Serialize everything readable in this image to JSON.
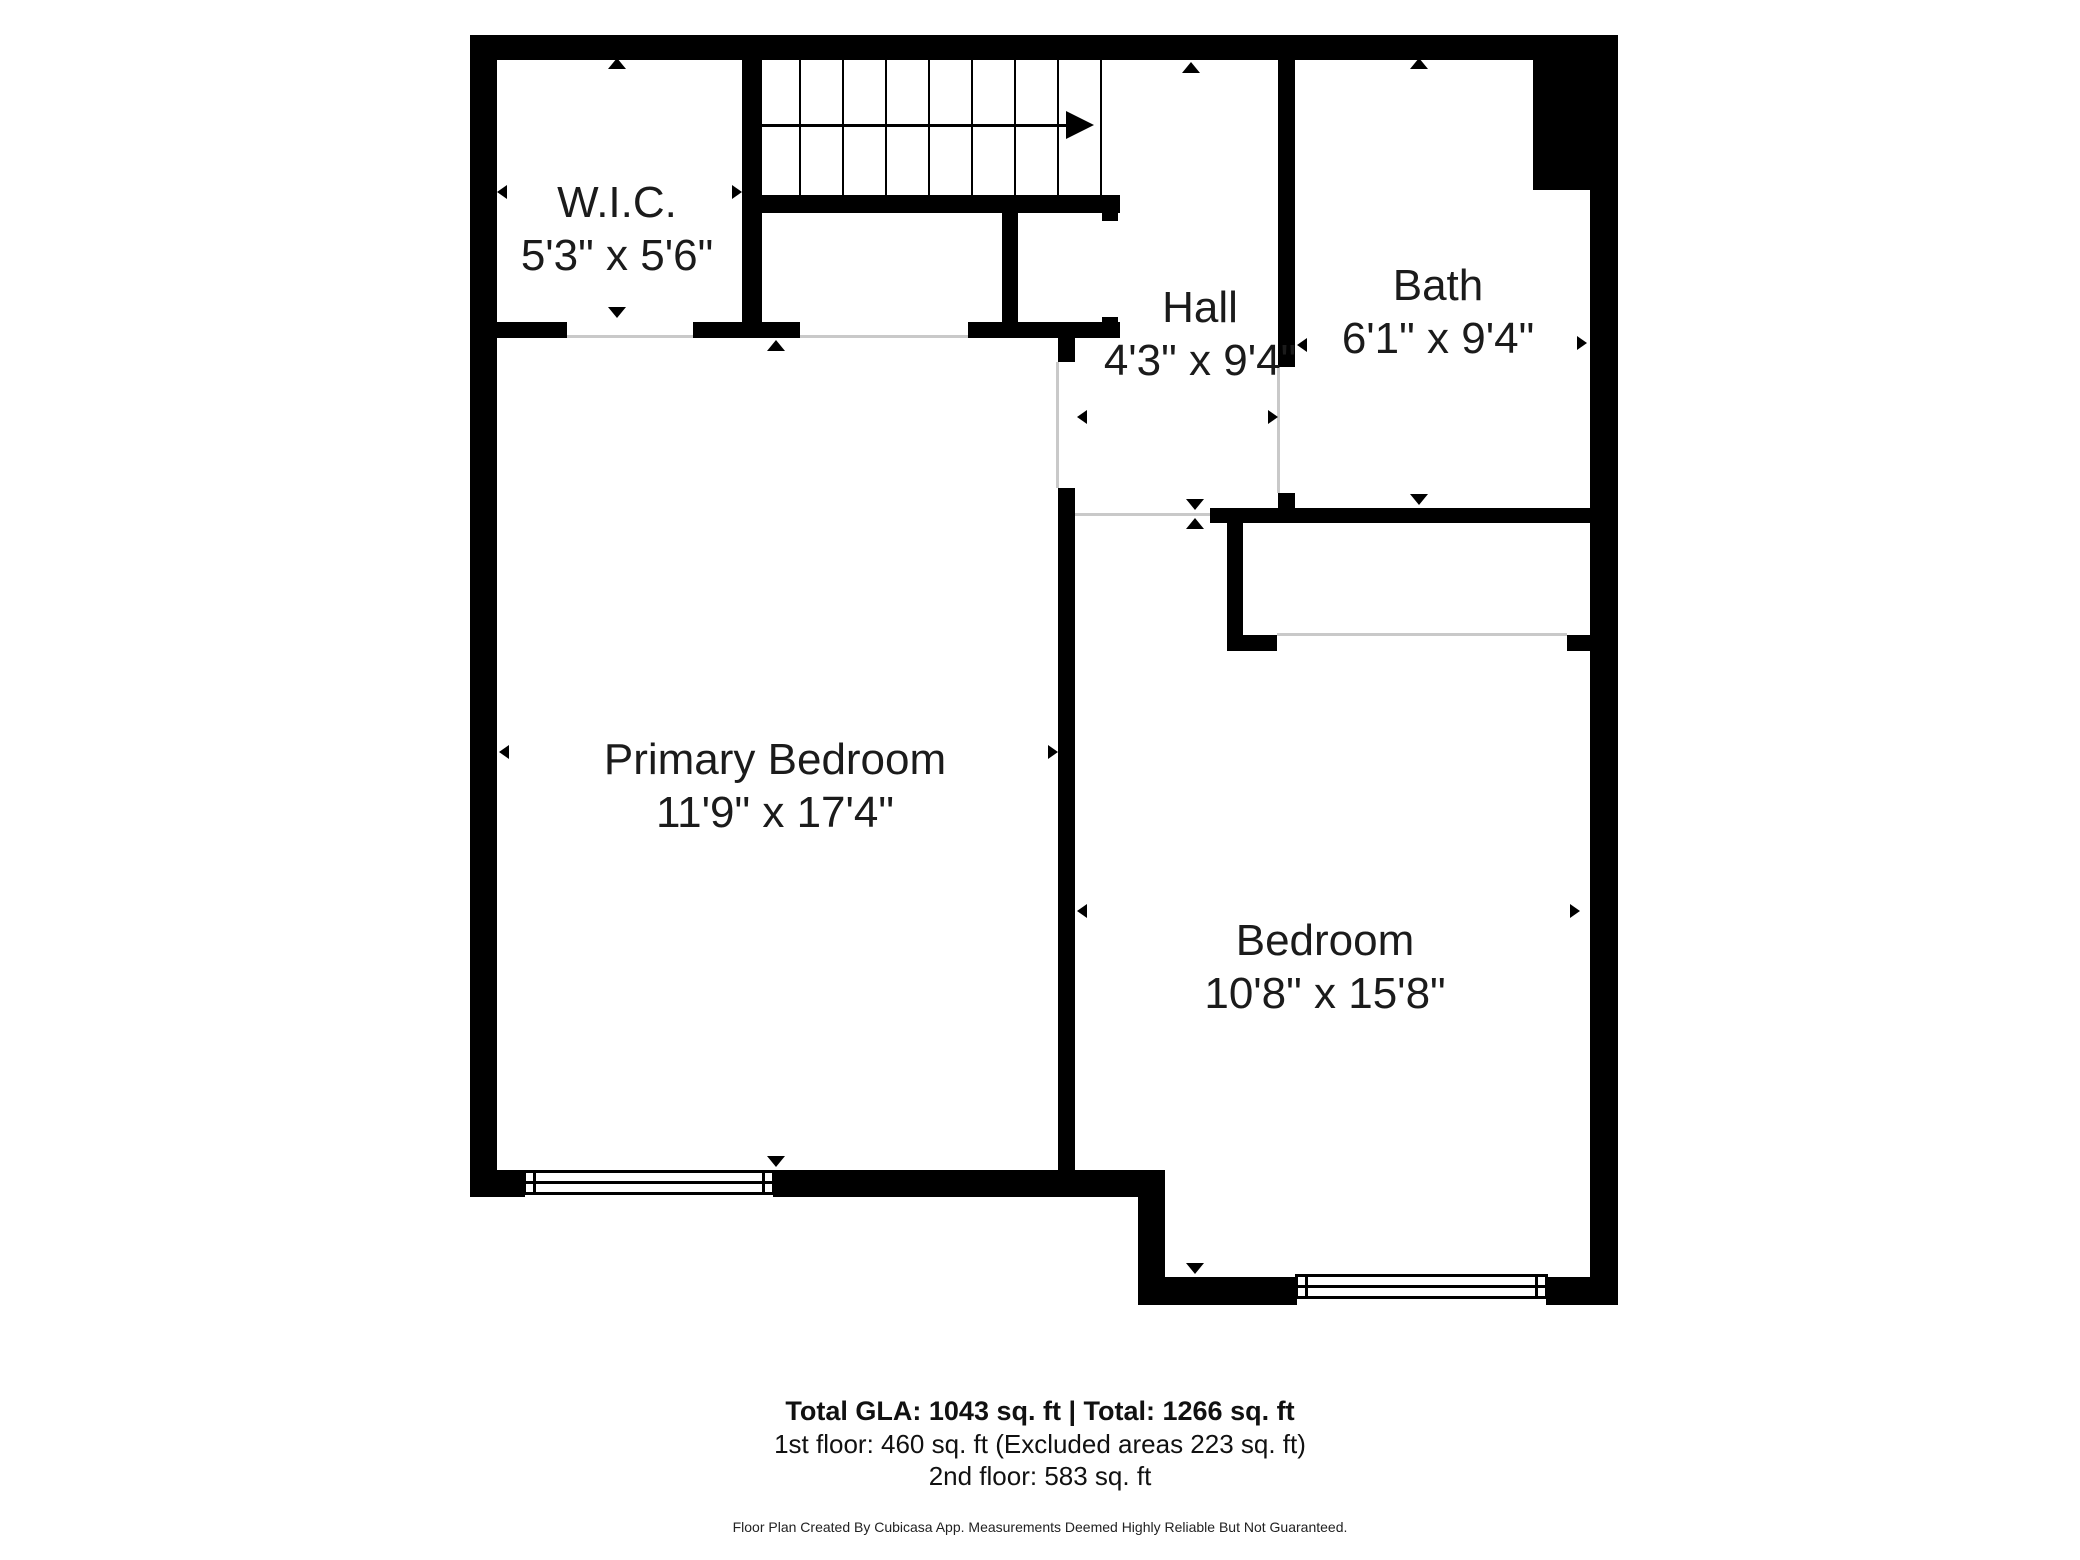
{
  "rooms": [
    {
      "id": "wic",
      "name": "W.I.C.",
      "dimensions": "5'3\" x 5'6\""
    },
    {
      "id": "hall",
      "name": "Hall",
      "dimensions": "4'3\" x 9'4\""
    },
    {
      "id": "bath",
      "name": "Bath",
      "dimensions": "6'1\" x 9'4\""
    },
    {
      "id": "primary-bedroom",
      "name": "Primary Bedroom",
      "dimensions": "11'9\" x 17'4\""
    },
    {
      "id": "bedroom",
      "name": "Bedroom",
      "dimensions": "10'8\" x 15'8\""
    }
  ],
  "footer": {
    "totals": "Total GLA: 1043 sq. ft | Total: 1266 sq. ft",
    "first_floor": "1st floor: 460 sq. ft (Excluded areas 223 sq. ft)",
    "second_floor": "2nd floor: 583 sq. ft",
    "disclaimer": "Floor Plan Created By Cubicasa App. Measurements Deemed Highly Reliable But Not Guaranteed."
  },
  "colors": {
    "wall": "#000000",
    "text": "#1b1b1b",
    "threshold": "#c9c9c9",
    "background": "#ffffff"
  }
}
